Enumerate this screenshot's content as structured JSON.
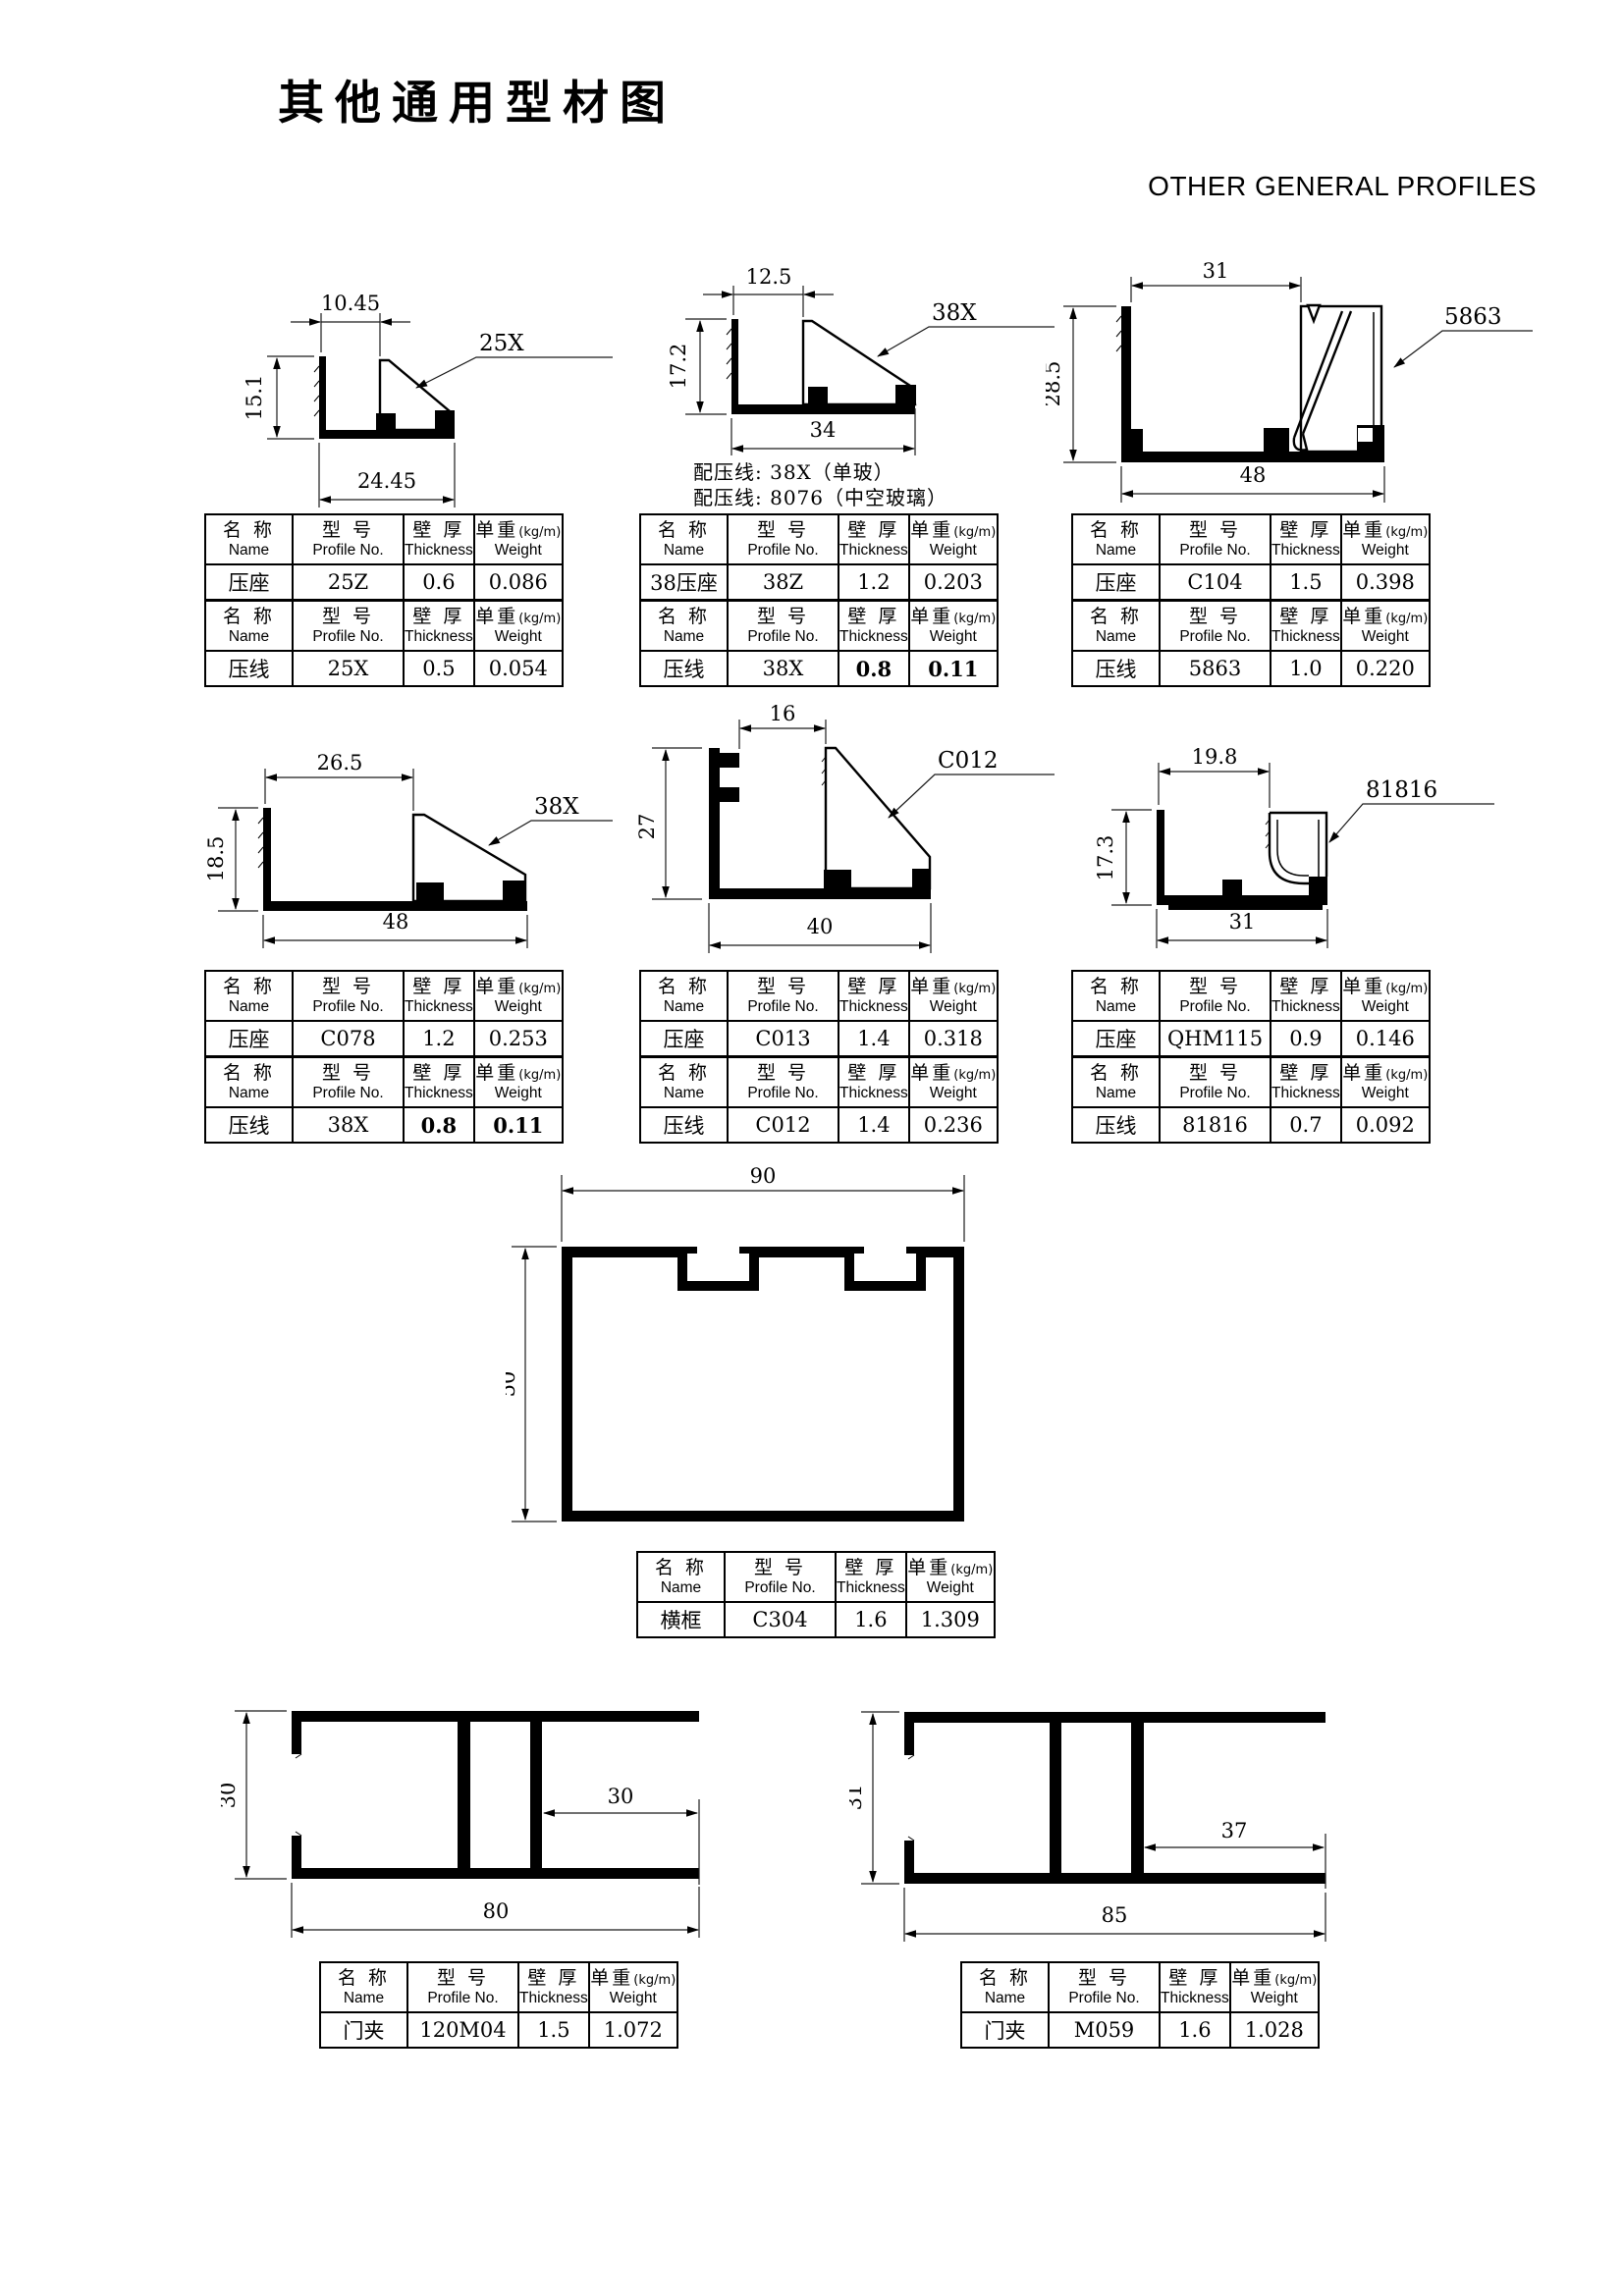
{
  "page": {
    "title": "其他通用型材图",
    "subtitle": "OTHER GENERAL PROFILES"
  },
  "table_header": {
    "name_cn": "名 称",
    "name_en": "Name",
    "model_cn": "型 号",
    "model_en": "Profile No.",
    "thickness_cn": "壁 厚",
    "thickness_en": "Thickness",
    "weight_cn": "单重",
    "weight_unit": "(kg/m)",
    "weight_en": "Weight"
  },
  "sections": {
    "s1": {
      "dim_top": "10.45",
      "dim_left": "15.1",
      "dim_bottom": "24.45",
      "callout": "25X",
      "row1": {
        "name": "压座",
        "model": "25Z",
        "thickness": "0.6",
        "weight": "0.086"
      },
      "row2": {
        "name": "压线",
        "model": "25X",
        "thickness": "0.5",
        "weight": "0.054"
      }
    },
    "s2": {
      "dim_top": "12.5",
      "dim_left": "17.2",
      "dim_bottom": "34",
      "callout": "38X",
      "note1": "配压线: 38X（单玻）",
      "note2": "配压线: 8076（中空玻璃）",
      "row1": {
        "name": "38压座",
        "model": "38Z",
        "thickness": "1.2",
        "weight": "0.203"
      },
      "row2": {
        "name": "压线",
        "model": "38X",
        "thickness": "0.8",
        "weight": "0.11"
      }
    },
    "s3": {
      "dim_top": "31",
      "dim_left": "28.5",
      "dim_bottom": "48",
      "callout": "5863",
      "row1": {
        "name": "压座",
        "model": "C104",
        "thickness": "1.5",
        "weight": "0.398"
      },
      "row2": {
        "name": "压线",
        "model": "5863",
        "thickness": "1.0",
        "weight": "0.220"
      }
    },
    "s4": {
      "dim_top": "26.5",
      "dim_left": "18.5",
      "dim_bottom": "48",
      "callout": "38X",
      "row1": {
        "name": "压座",
        "model": "C078",
        "thickness": "1.2",
        "weight": "0.253"
      },
      "row2": {
        "name": "压线",
        "model": "38X",
        "thickness": "0.8",
        "weight": "0.11"
      }
    },
    "s5": {
      "dim_top": "16",
      "dim_left": "27",
      "dim_bottom": "40",
      "callout": "C012",
      "row1": {
        "name": "压座",
        "model": "C013",
        "thickness": "1.4",
        "weight": "0.318"
      },
      "row2": {
        "name": "压线",
        "model": "C012",
        "thickness": "1.4",
        "weight": "0.236"
      }
    },
    "s6": {
      "dim_top": "19.8",
      "dim_left": "17.3",
      "dim_bottom": "31",
      "callout": "81816",
      "row1": {
        "name": "压座",
        "model": "QHM115",
        "thickness": "0.9",
        "weight": "0.146"
      },
      "row2": {
        "name": "压线",
        "model": "81816",
        "thickness": "0.7",
        "weight": "0.092"
      }
    },
    "s7": {
      "dim_top": "90",
      "dim_left": "50",
      "row1": {
        "name": "横框",
        "model": "C304",
        "thickness": "1.6",
        "weight": "1.309"
      }
    },
    "s8": {
      "dim_left": "30",
      "dim_inner": "30",
      "dim_bottom": "80",
      "row1": {
        "name": "门夹",
        "model": "120M04",
        "thickness": "1.5",
        "weight": "1.072"
      }
    },
    "s9": {
      "dim_left": "31",
      "dim_inner": "37",
      "dim_bottom": "85",
      "row1": {
        "name": "门夹",
        "model": "M059",
        "thickness": "1.6",
        "weight": "1.028"
      }
    }
  }
}
